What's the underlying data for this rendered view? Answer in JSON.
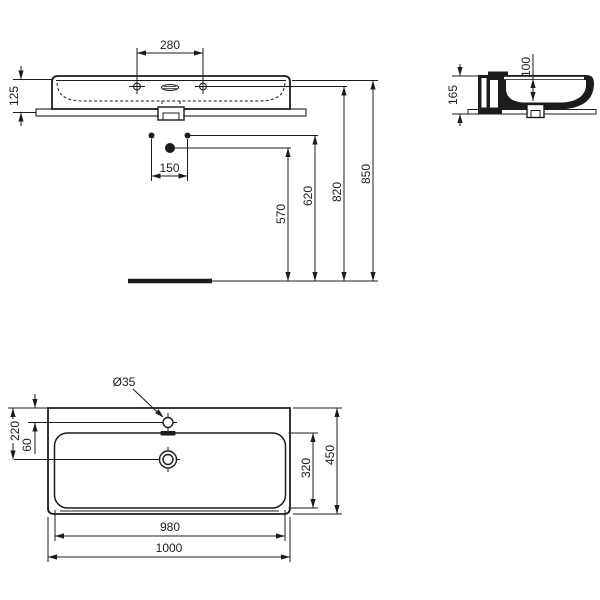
{
  "drawing": {
    "background_color": "#ffffff",
    "line_color": "#1c1c1c",
    "views": {
      "front_view": {
        "dims": {
          "tap_hole_spacing": "280",
          "front_height": "125"
        }
      },
      "installation": {
        "dims": {
          "fixing_hole_spacing": "150",
          "drain_height": "570",
          "fixing_height": "620",
          "tap_line_height": "820",
          "rim_height": "850"
        }
      },
      "side_view": {
        "dims": {
          "total_height": "165",
          "bowl_depth": "100"
        }
      },
      "plan_view": {
        "dims": {
          "tap_hole_diameter": "Ø35",
          "tap_hole_inset": "60",
          "drain_inset": "220",
          "bowl_depth": "320",
          "overall_depth": "450",
          "bowl_width": "980",
          "overall_width": "1000"
        }
      }
    }
  }
}
